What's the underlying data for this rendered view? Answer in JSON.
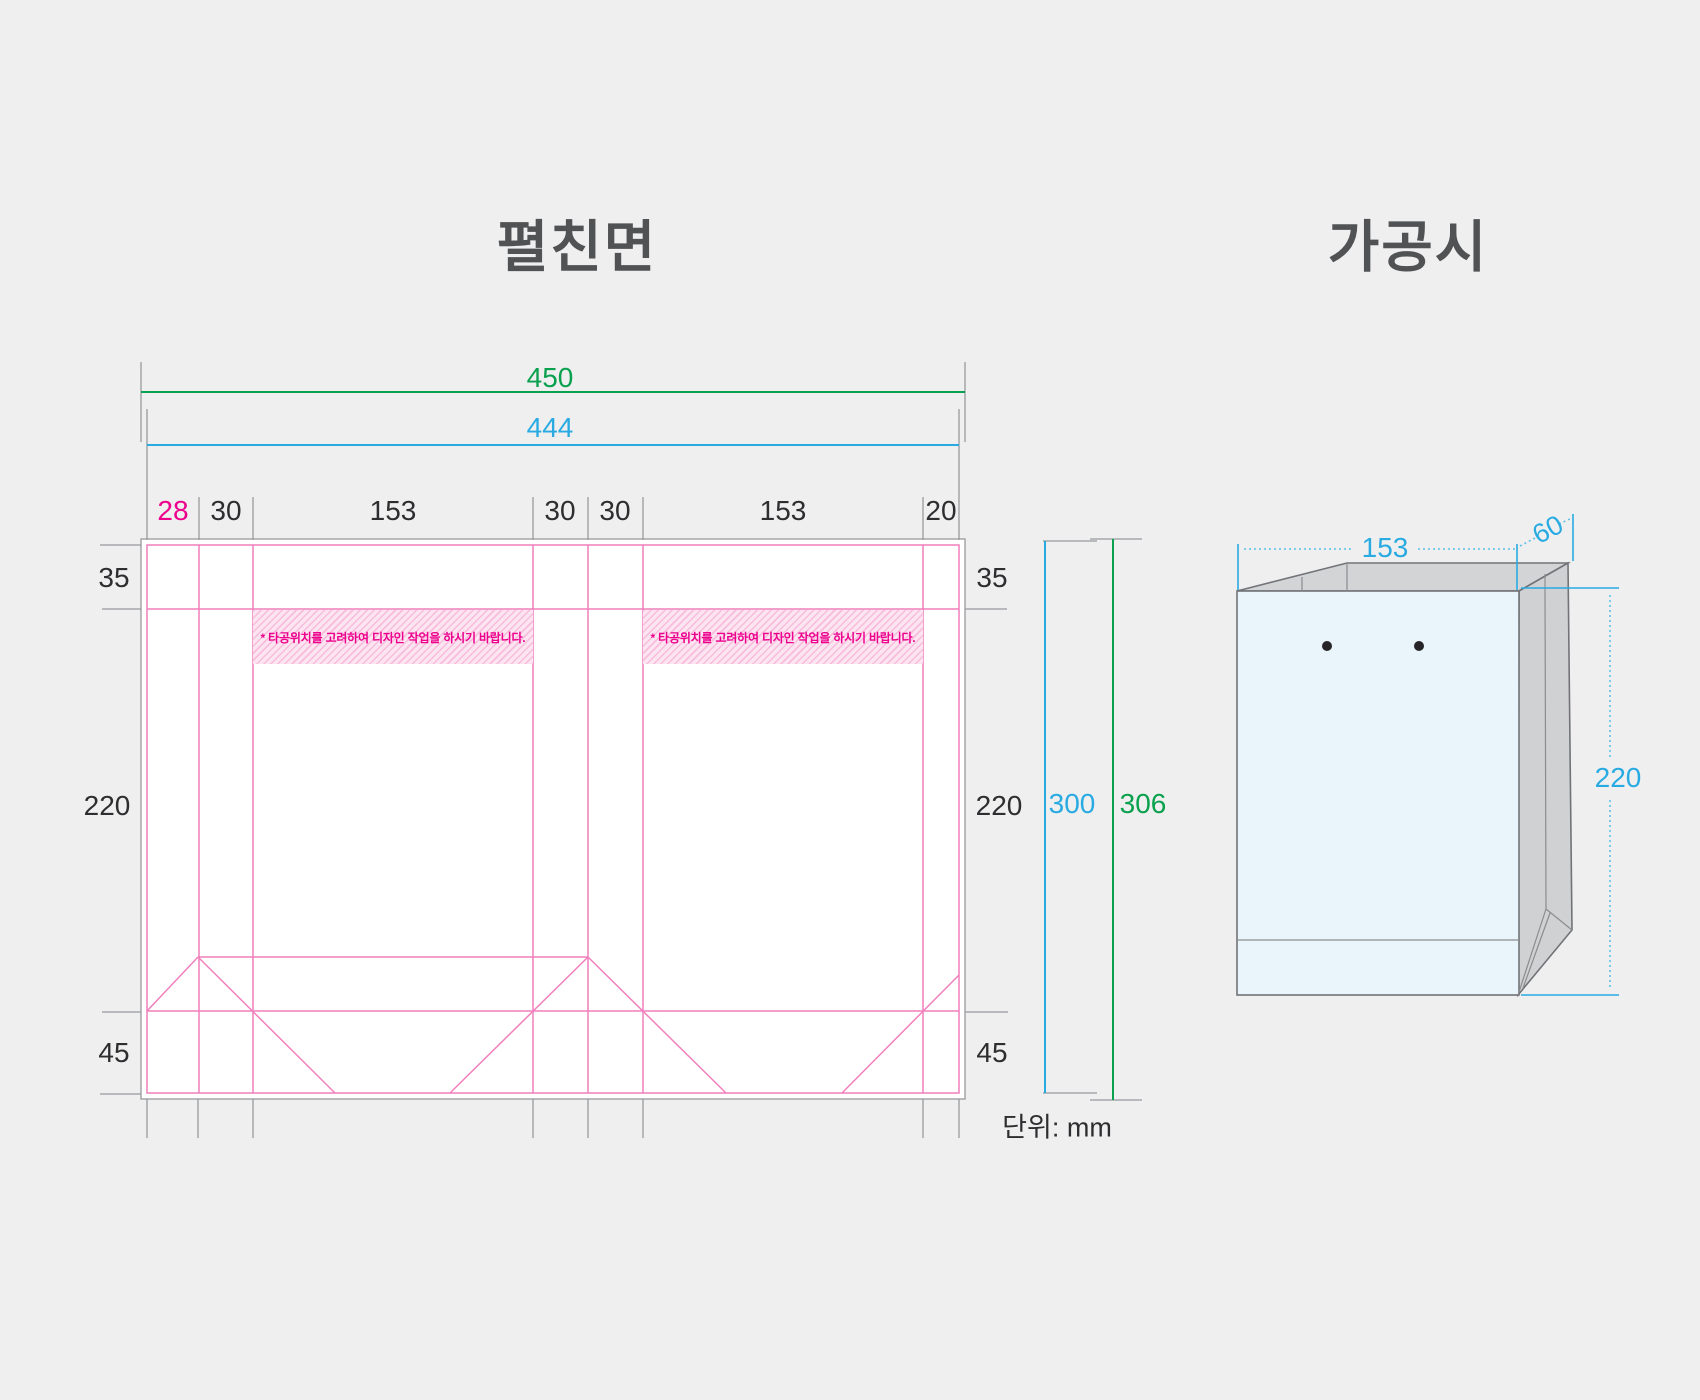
{
  "titles": {
    "flat": "펼친면",
    "assembled": "가공시"
  },
  "unit_label": "단위: mm",
  "punch_warning": "*  타공위치를 고려하여 디자인 작업을 하시기 바랍니다.",
  "flat_view": {
    "width_bleed": "450",
    "width_trim": "444",
    "column_labels": [
      "28",
      "30",
      "153",
      "30",
      "30",
      "153",
      "20"
    ],
    "row_labels": {
      "top": "35",
      "middle": "220",
      "bottom": "45"
    },
    "height_trim": "300",
    "height_bleed": "306"
  },
  "assembled_view": {
    "width": "153",
    "depth": "60",
    "height": "220"
  },
  "colors": {
    "background": "#efeff0",
    "dimension_green": "#0aa14e",
    "dimension_blue": "#29abe2",
    "cutline_pink": "#f17fbc",
    "warning_magenta": "#ec008c",
    "guide_gray": "#939598",
    "text_dark": "#2e2e30",
    "bag_front_fill": "#e9f4fb",
    "bag_side_fill": "#d0d1d3",
    "bag_top_fill": "#d3d4d6"
  }
}
